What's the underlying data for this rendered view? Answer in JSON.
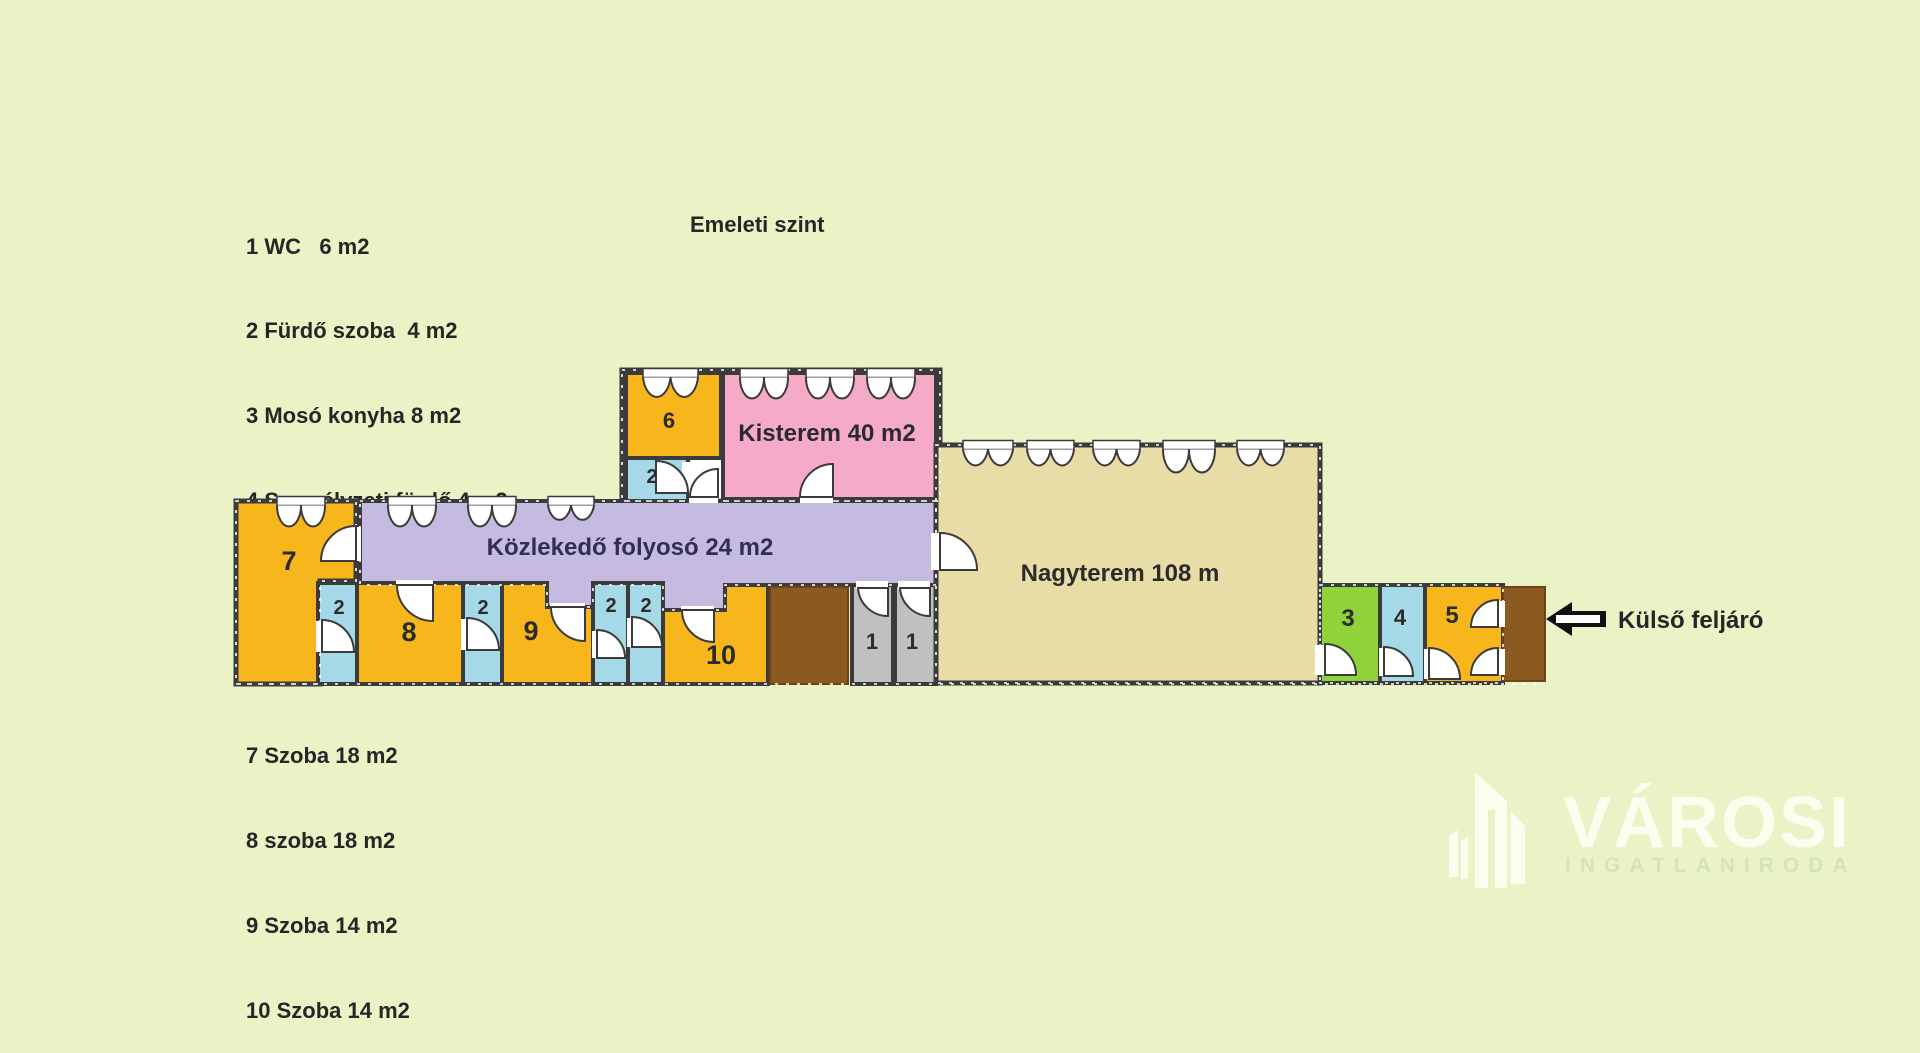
{
  "title": "Emeleti szint",
  "legend": [
    "1 WC   6 m2",
    "2 Fürdő szoba  4 m2",
    "3 Mosó konyha 8 m2",
    "4 Személyzeti fürdő 4 m2",
    "5 Személyzeti szoba 12 m2",
    "6 Szoba 9 m2",
    "7 Szoba 18 m2",
    "8 szoba 18 m2",
    "9 Szoba 14 m2",
    "10 Szoba 14 m2"
  ],
  "rooms": {
    "room7": "7",
    "room6": "6",
    "room2top": "2",
    "kisterem": "Kisterem 40 m2",
    "corridor": "Közlekedő folyosó 24 m2",
    "nagyterem": "Nagyterem 108 m",
    "room2a": "2",
    "room8": "8",
    "room2b": "2",
    "room9": "9",
    "room2c": "2",
    "room2d": "2",
    "room10": "10",
    "room1a": "1",
    "room1b": "1",
    "room3": "3",
    "room4": "4",
    "room5": "5"
  },
  "annotations": {
    "external_entrance": "Külső feljáró"
  },
  "logo": {
    "name": "VÁROSI",
    "subtitle": "INGATLANIRODA"
  },
  "colors": {
    "background": "#e9f3c5",
    "wall": "#3b3b3b",
    "room_orange": "#f7b71c",
    "room_blue": "#a5d9e7",
    "room_pink": "#f5abc7",
    "corridor_lavender": "#c5bae0",
    "hall_beige": "#e9dda7",
    "room_green": "#8fd23a",
    "room_gray": "#c0c0c0",
    "stairs_brown": "#8a5a21",
    "arrow_black": "#111111",
    "text": "#262626",
    "logo_white": "#fbfdee",
    "logo_subtitle": "#d7e2bd"
  }
}
